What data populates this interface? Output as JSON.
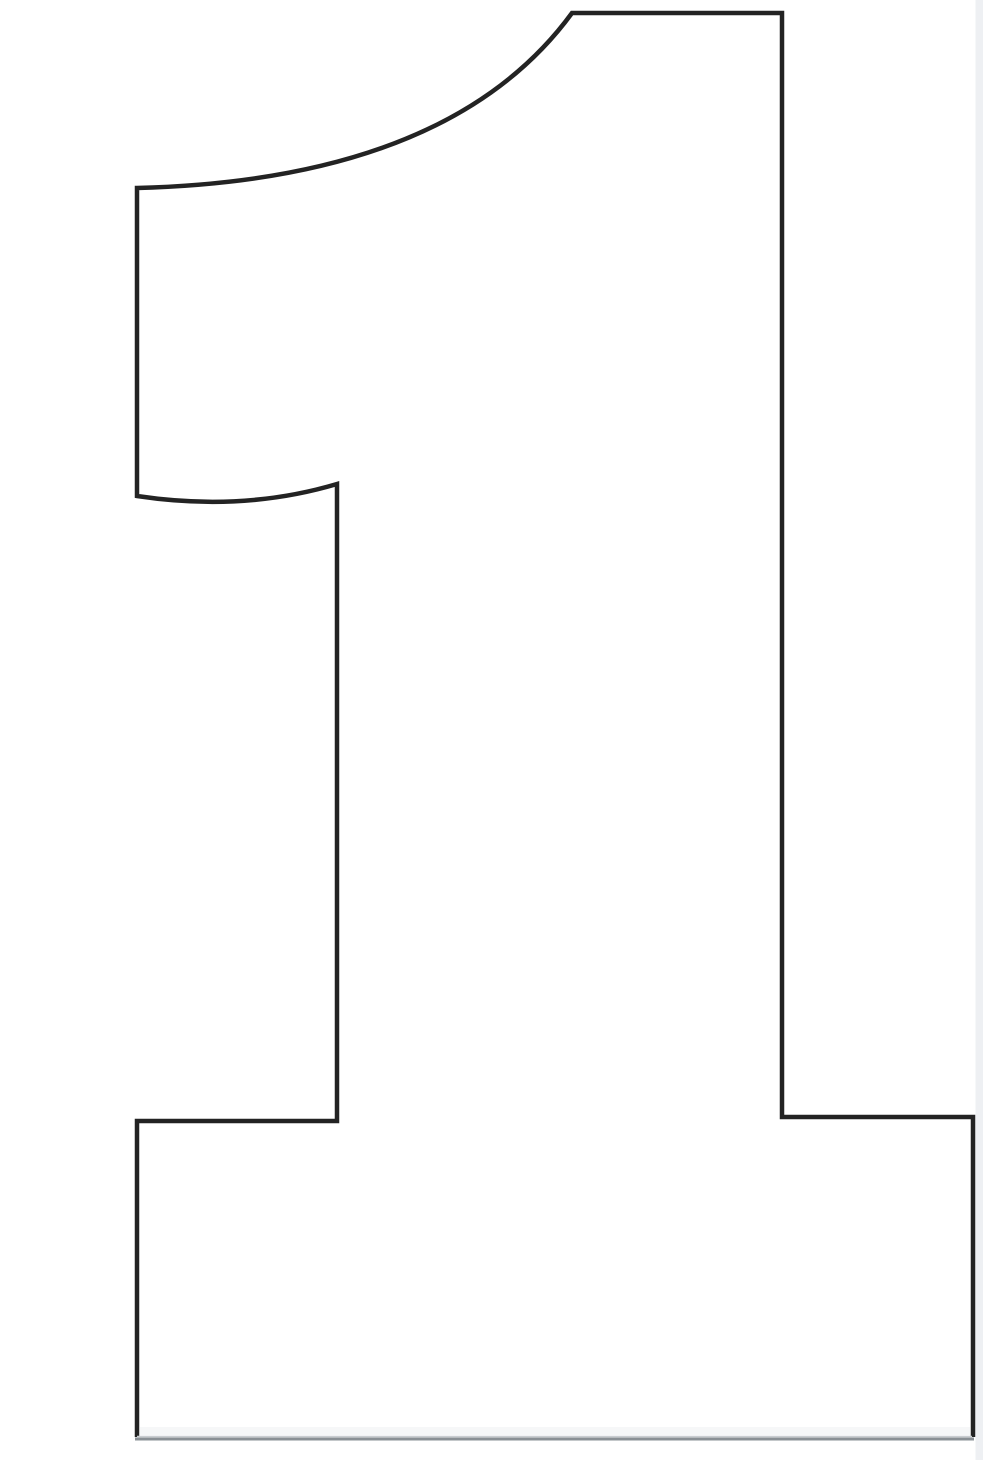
{
  "figure": {
    "label": "numeral-1-outline-stencil",
    "description": "Large black outline of the number 1, printable stencil style, on a white page",
    "background_color": "#ffffff",
    "outline_color": "#232323",
    "outline_width": "4.5",
    "baseline_color": "#8a9095",
    "baseline_highlight_color": "#c9cdd1",
    "baseline_width": "3",
    "edge_strip_color": "#eef0f3",
    "inner_shade_color": "#f6f7f8",
    "outline_path": "M 137 1437 L 137 1121 L 337 1121 L 337 484 Q 243 512 137 496 L 137 188 Q 450 180 572 13 L 782 13 L 782 1117 L 973 1117 L 973 1437",
    "baseline_path": "M 135 1439 L 974 1439",
    "baseline_highlight_path": "M 137 1436.5 L 972 1436.5",
    "inner_shade_rect": {
      "x": "140",
      "y": "1427",
      "w": "830",
      "h": "8"
    },
    "edge_strip_rect": {
      "x": "975.5",
      "y": "0",
      "w": "7.5",
      "h": "1460"
    },
    "canvas": {
      "width": "985",
      "height": "1460",
      "viewbox": "0 0 985 1460"
    }
  }
}
